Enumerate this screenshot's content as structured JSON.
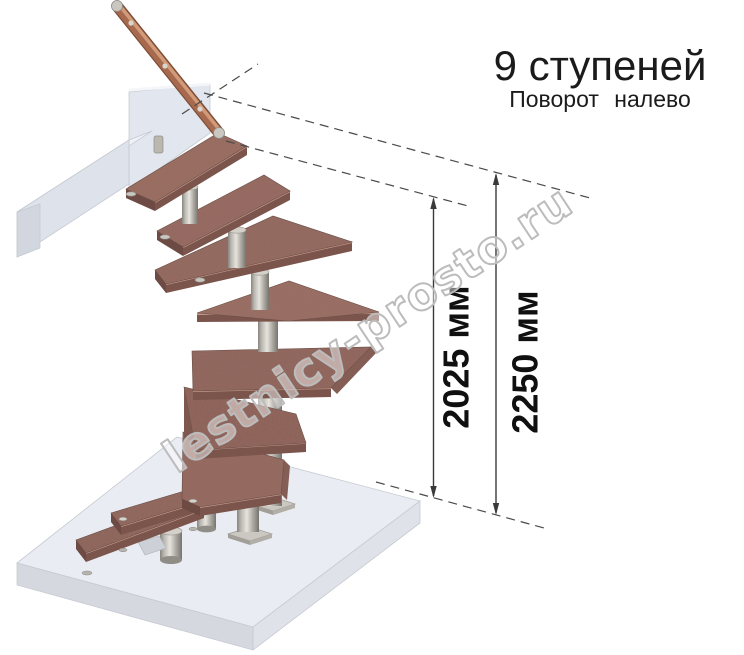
{
  "header": {
    "title": "9 ступеней",
    "subtitle": "Поворот налево"
  },
  "dimensions": [
    {
      "id": "height-to-top-step",
      "label": "2025 мм",
      "value_mm": 2025
    },
    {
      "id": "floor-to-floor-height",
      "label": "2250 мм",
      "value_mm": 2250
    }
  ],
  "watermark": {
    "text": "lestnicy-prosto.ru"
  },
  "stair": {
    "step_count": 9,
    "turn_direction": "налево",
    "components": [
      "ступени из дерева",
      "деревянный поручень",
      "металлические балясины",
      "модульные опоры",
      "верхняя площадка",
      "нижнее основание"
    ]
  },
  "colors": {
    "tread_wood": "#96695f",
    "tread_edge": "#7b544c",
    "handrail_wood": "#a86a4e",
    "metal": "#b9b7b0",
    "platform": "#e9ecf2",
    "dimension_line": "#3a3a3a",
    "watermark_outline": "#bcbcbc",
    "background": "#ffffff"
  }
}
